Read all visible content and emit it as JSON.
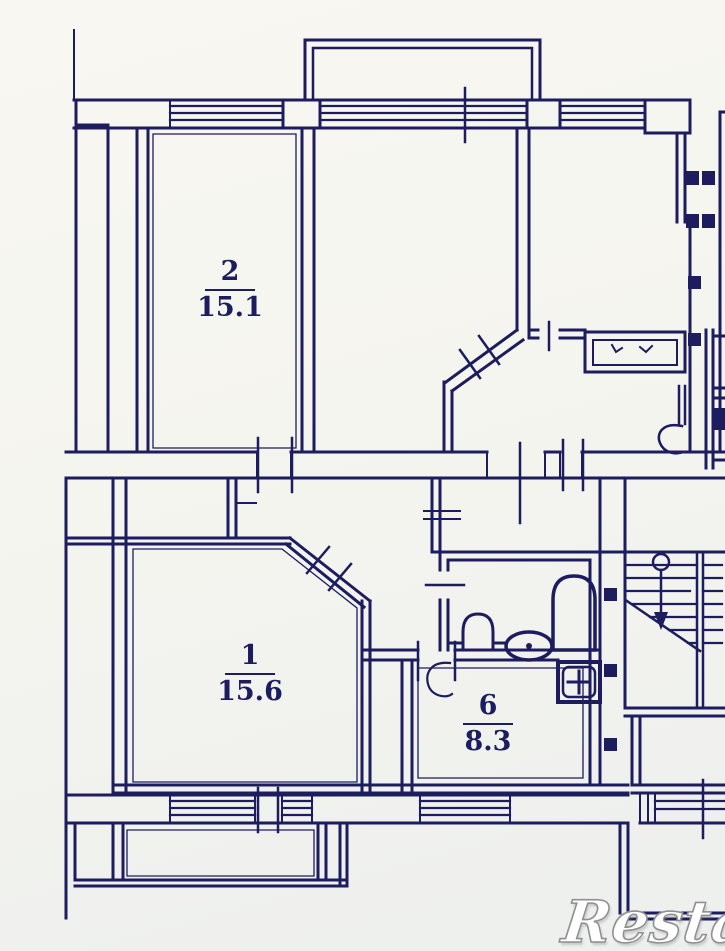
{
  "meta": {
    "title": "apartment-floor-plan",
    "watermark": "Restate"
  },
  "palette": {
    "ink": "#1c1c5e",
    "paper_top": "#f8f7f1",
    "paper_bottom": "#edefee",
    "watermark_fill": "#ffffff",
    "watermark_outline": "#8f8f8f"
  },
  "rooms": [
    {
      "id": "room-2",
      "number": "2",
      "area": "15.1"
    },
    {
      "id": "room-1",
      "number": "1",
      "area": "15.6"
    },
    {
      "id": "room-6",
      "number": "6",
      "area": "8.3"
    }
  ],
  "fixtures": [
    "bathtub",
    "toilet",
    "sink",
    "kitchen-washbasin",
    "wardrobe",
    "staircase-with-up-arrow",
    "door-swing",
    "ventilation-blocks"
  ]
}
